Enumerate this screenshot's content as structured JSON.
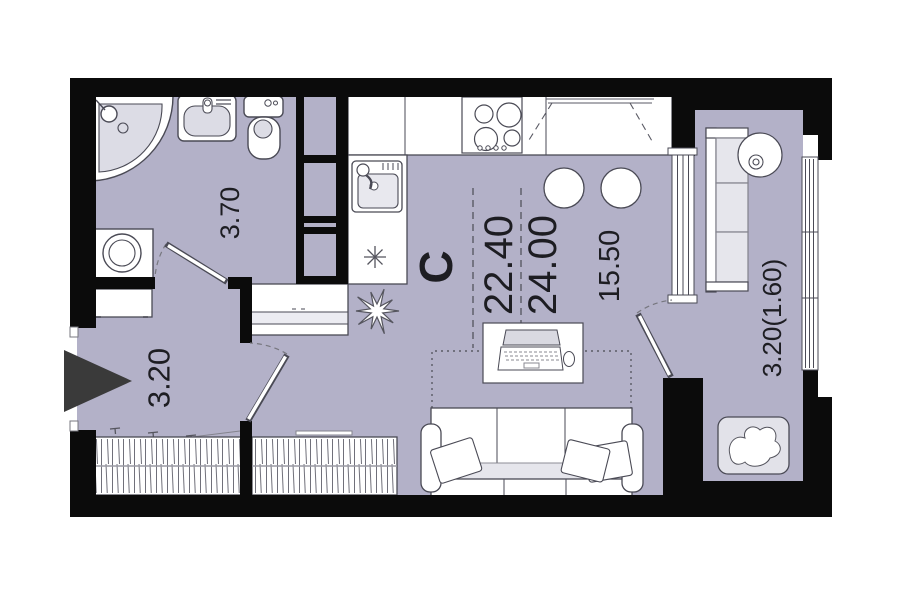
{
  "plan": {
    "type": "studio apartment floor plan",
    "north_indicator": "С",
    "dimensions": {
      "bathroom_depth": "3.70",
      "hallway_width": "3.20",
      "living_area": "22.40",
      "total_area": "24.00",
      "room_depth": "15.50",
      "balcony_area": "3.20(1.60)"
    },
    "colors": {
      "wall": "#0b0b0b",
      "floor": "#b3b1c8",
      "fixture_fill": "#dcdce5",
      "cushion_fill": "#e6e6ec",
      "outline": "#4a4a55",
      "entrance_arrow": "#3a3a3a"
    }
  }
}
